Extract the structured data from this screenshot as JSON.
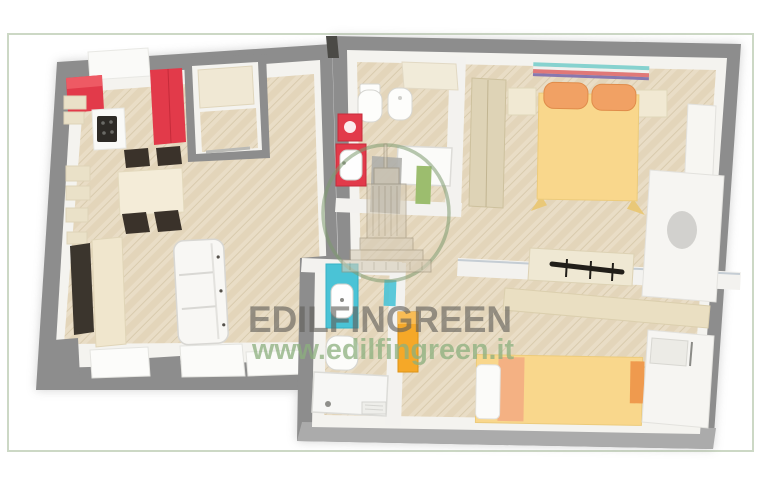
{
  "frame": {
    "background": "#ffffff",
    "border_color": "#ccd8c5"
  },
  "watermark": {
    "brand": "EDILFINGREEN",
    "website": "www.edilfingreen.it",
    "brand_color": "#615f5a",
    "website_color": "#8cb07e",
    "ring_color": "#7d9b70",
    "logo_icon": "empire-state-building-icon"
  },
  "palette": {
    "wall_gray": "#8d8d8d",
    "wall_gray_light": "#ababab",
    "inner_wall_white": "#f4f3ef",
    "floor_wood": "#e9ddc6",
    "floor_wood_stripe": "#e0d2b7",
    "kitchen_red": "#e23a4a",
    "bed_yellow": "#f9d78c",
    "pillow_orange": "#f1a164",
    "sink_teal": "#4ac3d6",
    "cabinet_orange": "#f5a828",
    "furniture_cream": "#f0e6cd",
    "furniture_dark": "#3b352d"
  },
  "floorplan": {
    "type": "3d-top-down-floor-plan",
    "rooms": [
      {
        "name": "living-room-kitchen",
        "furniture": [
          "red-kitchen-cabinets",
          "cooktop",
          "fridge-counter",
          "wall-shelves",
          "dining-table",
          "four-dark-chairs",
          "tv-panel",
          "sideboard",
          "white-sofa",
          "bay-window-sills"
        ]
      },
      {
        "name": "storage-closet",
        "furniture": [
          "built-in-wardrobe"
        ]
      },
      {
        "name": "bathroom-top",
        "furniture": [
          "toilet",
          "bidet",
          "red-washing-machine",
          "red-sink-cabinet",
          "shower",
          "open-door",
          "green-mat"
        ]
      },
      {
        "name": "bedroom-double",
        "furniture": [
          "double-bed-yellow",
          "two-orange-pillows",
          "headboard-color-strip",
          "nightstand-left",
          "nightstand-right",
          "tall-wardrobe",
          "dresser",
          "wardrobe-with-oval-mirror"
        ]
      },
      {
        "name": "hallway",
        "furniture": [
          "coat-rack-with-black-hooks",
          "orange-tall-cabinet",
          "teal-towel"
        ]
      },
      {
        "name": "bathroom-bottom",
        "furniture": [
          "teal-sink-cabinet",
          "toilet",
          "shower-tray"
        ]
      },
      {
        "name": "bedroom-single",
        "furniture": [
          "bed-yellow",
          "white-pillow",
          "wall-shelf",
          "wardrobe-open-door"
        ]
      }
    ]
  }
}
